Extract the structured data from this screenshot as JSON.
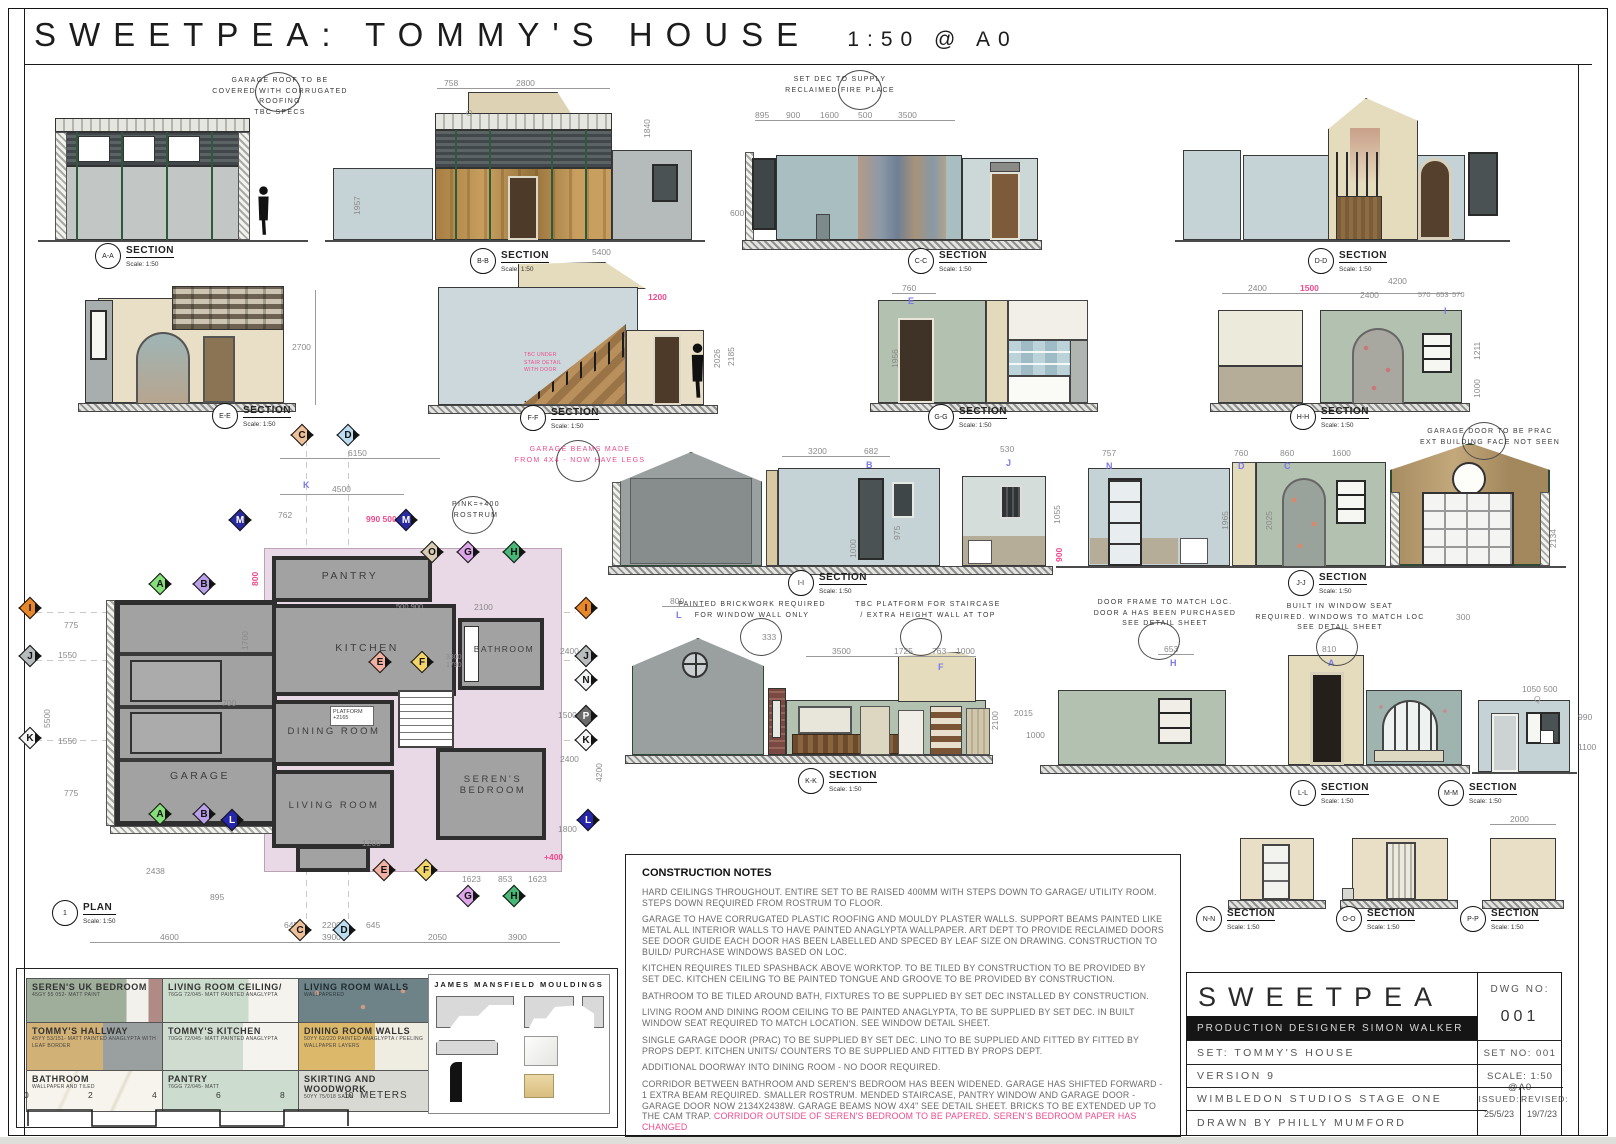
{
  "sheet": {
    "title": "SWEETPEA: TOMMY'S HOUSE",
    "scale_note": "1:50  @  A0"
  },
  "labels": {
    "section": "SECTION",
    "scale": "Scale: 1:50",
    "plan": "PLAN",
    "plan_no": "1"
  },
  "sids": {
    "aa": "A-A",
    "bb": "B-B",
    "cc": "C-C",
    "dd": "D-D",
    "ee": "E-E",
    "ff": "F-F",
    "gg": "G-G",
    "hh": "H-H",
    "ii": "I-I",
    "jj": "J-J",
    "kk": "K-K",
    "ll": "L-L",
    "mm": "M-M",
    "nn": "N-N",
    "oo": "O-O",
    "pp": "P-P"
  },
  "callouts": {
    "garage_roof": "GARAGE ROOF TO BE\nCOVERED WITH CORRUGATED ROOFING\nTBC SPECS",
    "fireplace": "SET DEC TO SUPPLY\nRECLAIMED FIRE PLACE",
    "garage_beams": "GARAGE BEAMS MADE\nFROM 4X4 - NOW HAVE LEGS",
    "rostrum": "PINK=+400\nROSTRUM",
    "garage_door": "GARAGE DOOR TO BE PRAC\nEXT BUILDING FACE NOT SEEN",
    "brickwork": "PAINTED BRICKWORK REQUIRED\nFOR WINDOW WALL ONLY",
    "platform": "TBC PLATFORM FOR STAIRCASE\n/ EXTRA HEIGHT WALL AT TOP",
    "doorframe": "DOOR FRAME TO MATCH LOC.\nDOOR A HAS BEEN PURCHASED\nSEE DETAIL SHEET",
    "windowseat": "BUILT IN WINDOW SEAT\nREQUIRED. WINDOWS TO MATCH LOC\nSEE DETAIL SHEET",
    "stair_tbc": "TBC UNDER STAIR DETAIL WITH DOOR"
  },
  "markers": {
    "a": "A",
    "b": "B",
    "c": "C",
    "d": "D",
    "e": "E",
    "f": "F",
    "g": "G",
    "h": "H",
    "i": "I",
    "j": "J",
    "k": "K",
    "l": "L",
    "m": "M",
    "n": "N",
    "o": "O",
    "p": "P",
    "q": "Q"
  },
  "plan": {
    "rooms": {
      "garage": "GARAGE",
      "pantry": "PANTRY",
      "kitchen": "KITCHEN",
      "bathroom": "BATHROOM",
      "dining": "DINING ROOM",
      "living": "LIVING ROOM",
      "seren": "SEREN'S\nBEDROOM"
    },
    "platform": "PLATFORM\n+2165"
  },
  "dims": {
    "t6150": "6150",
    "t4500": "4500",
    "t762": "762",
    "t990": "990  500",
    "v800": "800",
    "k_letter": "K",
    "l775a": "775",
    "l1550a": "1550",
    "v5500": "5500",
    "l1550b": "1550",
    "l775b": "775",
    "b2438": "2438",
    "b4600": "4600",
    "b895": "895",
    "b645a": "645",
    "b2200": "2200",
    "b645b": "645",
    "b3900a": "3900",
    "b2050": "2050",
    "b3900b": "3900",
    "b1623a": "1623",
    "b853": "853",
    "b1623b": "1623",
    "r2400a": "2400",
    "r1500": "1500",
    "r2400b": "2400",
    "r4200": "4200",
    "r1800": "1800",
    "g1200": "1200",
    "v1700": "1700",
    "v700": "700",
    "s3300": "3300",
    "s1790": "1790",
    "s2100": "2100",
    "s900": "500  900",
    "p400": "+400"
  },
  "sd": {
    "bb758": "758",
    "bb2800": "2800",
    "bbO": "O",
    "bb1840": "1840",
    "bb1957": "1957",
    "bb5400": "5400",
    "cc895": "895",
    "cc900": "900",
    "cc1600": "1600",
    "cc500": "500",
    "cc3500": "3500",
    "cc600": "600",
    "ff2700": "2700",
    "ff1200": "1200",
    "ff2026": "2026",
    "ff2185": "2185",
    "gg760": "760",
    "ggE": "E",
    "gg1956": "1956",
    "hh2400a": "2400",
    "hh1500": "1500",
    "hh4200": "4200",
    "hh2400b": "2400",
    "hh570a": "570",
    "hh653": "653",
    "hh570b": "570",
    "hhI": "I",
    "hh1211": "1211",
    "hh1000": "1000",
    "ii3200": "3200",
    "ii682": "682",
    "iiB": "B",
    "ii975": "975",
    "ii1000": "1000",
    "ii530": "530",
    "iiJ": "J",
    "ii1055": "1055",
    "ii900": "900",
    "jj757": "757",
    "jjN": "N",
    "jj760": "760",
    "jjD": "D",
    "jj860": "860",
    "jjC": "C",
    "jj1600": "1600",
    "jj1965": "1965",
    "jj2025": "2025",
    "jj2134": "2134",
    "kk800": "800",
    "kkL": "L",
    "kk333": "333",
    "kk3500": "3500",
    "kk1725": "1725",
    "kk763": "763",
    "kk1000": "1000",
    "kkF": "F",
    "kk2100": "2100",
    "ll2015": "2015",
    "ll1000": "1000",
    "ll653": "653",
    "llH": "H",
    "ll810": "810",
    "llA": "A",
    "ll300": "300",
    "mm1050": "1050  500",
    "mmQ": "Q",
    "mm990": "990",
    "mm1100": "1100",
    "pp2000": "2000"
  },
  "notes": {
    "title": "CONSTRUCTION NOTES",
    "paras": [
      "HARD CEILINGS THROUGHOUT.  ENTIRE SET TO BE RAISED 400MM WITH STEPS DOWN TO GARAGE/ UTILITY ROOM.  STEPS DOWN REQUIRED FROM ROSTRUM TO FLOOR.",
      "GARAGE TO HAVE CORRUGATED PLASTIC ROOFING AND MOULDY PLASTER WALLS. SUPPORT BEAMS PAINTED LIKE METAL ALL INTERIOR WALLS TO HAVE PAINTED ANAGLYPTA WALLPAPER. ART DEPT TO PROVIDE RECLAIMED DOORS SEE DOOR GUIDE EACH DOOR HAS BEEN LABELLED AND SPECED BY LEAF SIZE ON DRAWING. CONSTRUCTION TO BUILD/ PURCHASE WINDOWS BASED ON LOC.",
      "KITCHEN REQUIRES TILED SPASHBACK ABOVE WORKTOP. TO BE TILED BY CONSTRUCTION TO BE PROVIDED BY SET DEC. KITCHEN CEILING TO BE PAINTED TONGUE AND GROOVE TO BE PROVIDED BY CONSTRUCTION.",
      "BATHROOM TO BE TILED AROUND BATH, FIXTURES TO BE SUPPLIED BY SET DEC INSTALLED BY CONSTRUCTION.",
      "LIVING ROOM AND DINING ROOM CEILING TO BE PAINTED ANAGLYPTA, TO BE SUPPLIED BY SET DEC. IN BUILT WINDOW SEAT REQUIRED TO MATCH LOCATION. SEE WINDOW DETAIL SHEET.",
      "SINGLE GARAGE DOOR (PRAC) TO BE SUPPLIED BY SET DEC. LINO TO BE SUPPLIED AND FITTED BY FITTED BY PROPS DEPT. KITCHEN UNITS/ COUNTERS TO BE SUPPLIED AND FITTED BY PROPS DEPT.",
      "ADDITIONAL DOORWAY INTO DINING ROOM - NO DOOR REQUIRED."
    ],
    "last": "CORRIDOR BETWEEN BATHROOM AND SEREN'S BEDROOM HAS BEEN WIDENED. GARAGE HAS SHIFTED FORWARD - 1 EXTRA BEAM REQUIRED. SMALLER ROSTRUM. MENDED STAIRCASE, PANTRY WINDOW AND GARAGE DOOR - GARAGE DOOR NOW 2134X2438W. GARAGE BEAMS NOW 4X4\" SEE DETAIL SHEET. BRICKS TO BE EXTENDED UP TO THE CAM TRAP. ",
    "last_pink": "CORRIDOR OUTSIDE OF SEREN'S BEDROOM TO BE PAPERED. SEREN'S BEDROOM PAPER HAS CHANGED"
  },
  "swatches": [
    {
      "name": "SEREN'S UK BEDROOM",
      "spec": "45GY 55 052- MATT PAINT"
    },
    {
      "name": "LIVING ROOM CEILING/",
      "spec": "76GG 72/045- MATT PAINTED ANAGLYPTA"
    },
    {
      "name": "LIVING ROOM WALLS",
      "spec": "WALLPAPERED"
    },
    {
      "name": "TOMMY'S HALLWAY",
      "spec": "45YY 53/151- MATT PAINTED ANAGLYPTA WITH LEAF BORDER"
    },
    {
      "name": "TOMMY'S KITCHEN",
      "spec": "70GG 72/045- MATT PAINTED ANAGLYPTA"
    },
    {
      "name": "DINING ROOM WALLS",
      "spec": "50YY 62/220  PAINTED ANAGLYPTA / PEELING WALLPAPER LAYERS"
    },
    {
      "name": "BATHROOM",
      "spec": "WALLPAPER AND TILED"
    },
    {
      "name": "PANTRY",
      "spec": "76GG 72/045- MATT"
    },
    {
      "name": "SKIRTING AND WOODWORK",
      "spec": "50YY 75/018 SATIN"
    }
  ],
  "mouldings": {
    "title": "JAMES MANSFIELD MOULDINGS"
  },
  "scalebar": {
    "ticks": [
      "0",
      "2",
      "4",
      "6",
      "8",
      "10"
    ],
    "unit": "METERS"
  },
  "titleblock": {
    "name": "SWEETPEA",
    "designer": "PRODUCTION DESIGNER SIMON WALKER",
    "set": "SET: TOMMY'S HOUSE",
    "version": "VERSION 9",
    "studio": "WIMBLEDON STUDIOS STAGE ONE",
    "drawn": "DRAWN BY PHILLY MUMFORD",
    "dwg_label": "DWG NO:",
    "dwg_no": "001",
    "set_no": "SET NO: 001",
    "scale": "SCALE: 1:50 @A0",
    "issued_label": "ISSUED:",
    "issued": "25/5/23",
    "revised_label": "REVISED:",
    "revised": "19/7/23"
  },
  "colors": {
    "annotation_pink": "#ee4b8d",
    "marker_blue": "#7a7ae8",
    "paper": "#ffffff"
  }
}
